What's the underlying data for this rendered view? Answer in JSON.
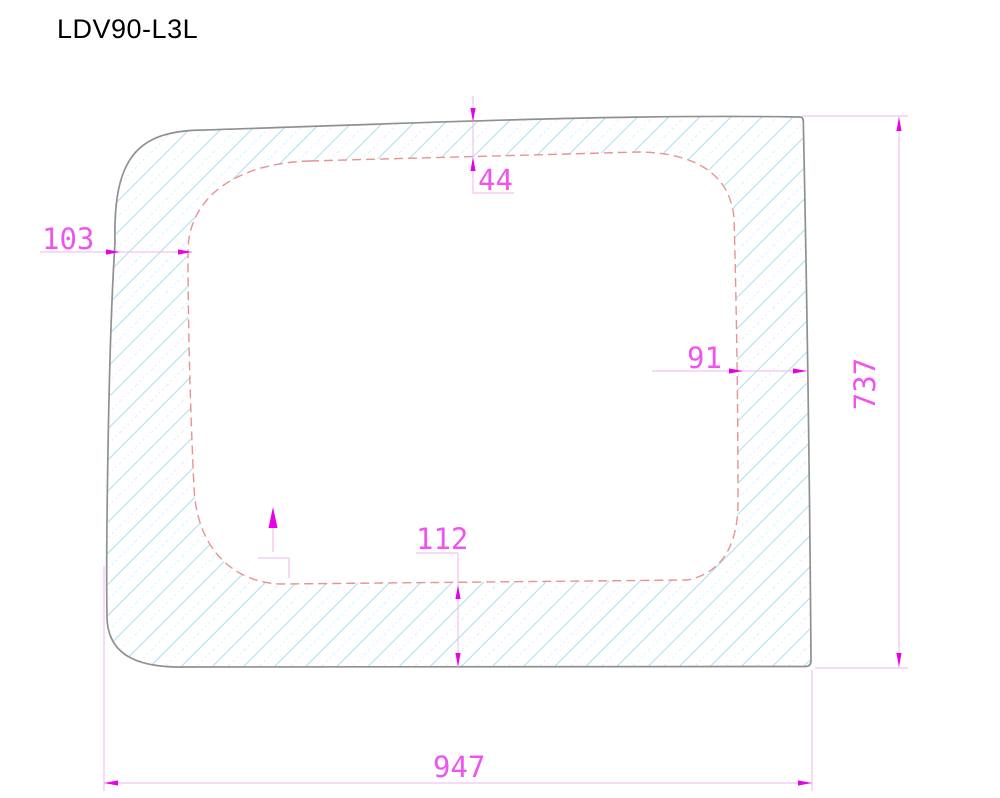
{
  "title": "LDV90-L3L",
  "dimensions": {
    "top_offset": "44",
    "left_offset": "103",
    "right_offset": "91",
    "bottom_offset": "112",
    "overall_width": "947",
    "overall_height": "737"
  },
  "colors": {
    "dim-line": "#f0b6ec",
    "dim-arrow": "#e800e8",
    "dim-text": "#ee55ee",
    "hatch-line": "#a9def2",
    "hatch-line-light": "#cdeefb",
    "outline": "#909090",
    "seal-dashed": "#e89292",
    "background": "#ffffff",
    "title": "#000000"
  }
}
